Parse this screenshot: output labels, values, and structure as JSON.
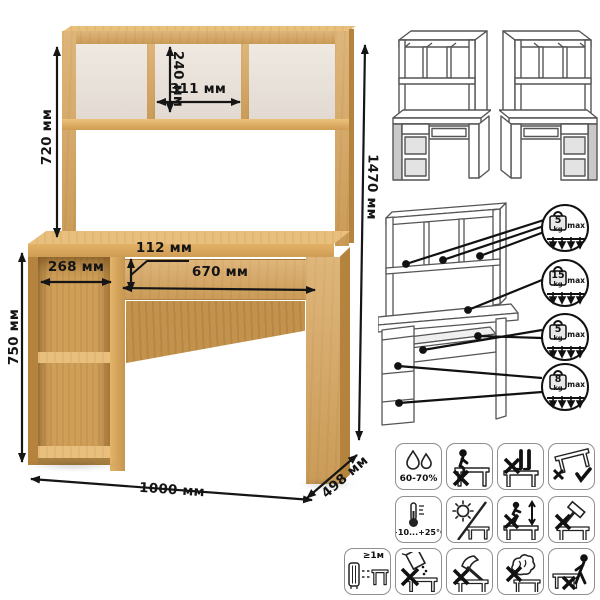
{
  "desk_dimensions": {
    "hutch_height": "720 мм",
    "top_cubby_height": "240 мм",
    "top_cubby_width": "311 мм",
    "overall_height": "1470 мм",
    "drawer_height": "112 мм",
    "small_drawer_width": "268 мм",
    "large_drawer_width": "670 мм",
    "table_height": "750 мм",
    "overall_width": "1000 мм",
    "depth": "498 мм"
  },
  "load_limits": [
    {
      "value": "5",
      "unit": "kg",
      "max": "max"
    },
    {
      "value": "15",
      "unit": "kg",
      "max": "max"
    },
    {
      "value": "5",
      "unit": "kg",
      "max": "max"
    },
    {
      "value": "8",
      "unit": "kg",
      "max": "max"
    }
  ],
  "care_labels": {
    "humidity": "60-70%",
    "temperature": "+10...+25°C",
    "distance": "≥1м"
  },
  "colors": {
    "wood": "#d7a55d",
    "wood_light": "#e8bf7c",
    "wood_dark": "#b4843f",
    "back_panel": "#eae3dc",
    "outline": "#555555",
    "gray_fill": "#c9c9c9",
    "dimension_text": "#151515"
  }
}
